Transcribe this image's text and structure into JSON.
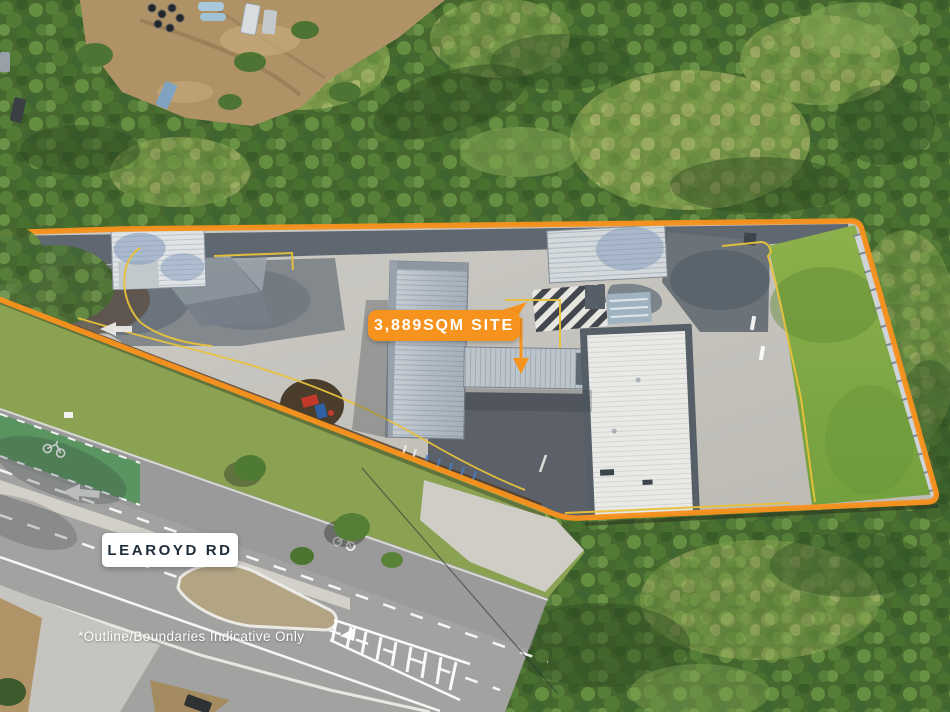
{
  "overlays": {
    "site_label": "3,889SQM SITE",
    "road_label": "LEAROYD RD",
    "disclaimer": "*Outline/Boundaries Indicative Only"
  },
  "colors": {
    "accent_orange": "#F6921E",
    "curb_yellow": "#E8C23C",
    "road_label_bg": "#FFFFFF",
    "road_label_text": "#1E2B3A",
    "overlay_text": "#FFFFFF"
  },
  "scene": {
    "type": "aerial-photo",
    "features": [
      "forest",
      "dirt-yard",
      "service-station-site",
      "learoyd-road",
      "site-boundary-outline"
    ]
  }
}
